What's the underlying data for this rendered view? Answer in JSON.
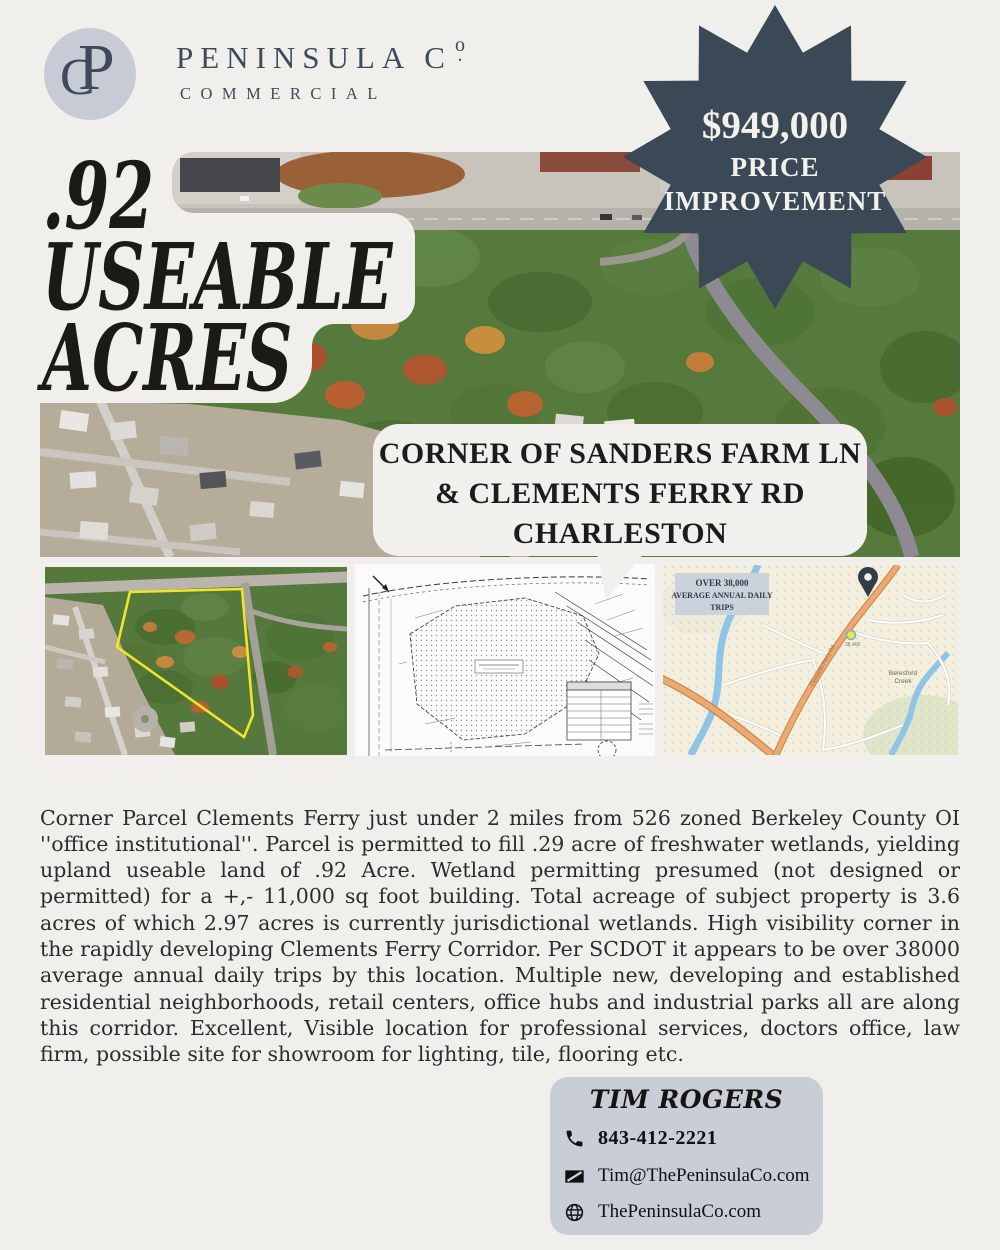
{
  "colors": {
    "cream": "#f1efeb",
    "navy": "#3b4957",
    "brand_navy": "#3e4a5c",
    "logo_circle": "#c6cbd6",
    "card_bg": "#c9cdd5",
    "headline_black": "#1a1a17",
    "parcel_outline_yellow": "#f2e428",
    "map_road_orange": "#eda96f"
  },
  "brand": {
    "monogram_c": "C",
    "monogram_p": "P",
    "name": "PENINSULA C",
    "name_o": "o",
    "name_dot": ".",
    "tagline": "COMMERCIAL"
  },
  "price_badge": {
    "amount": "$949,000",
    "line2": "PRICE",
    "line3": "IMPROVEMENT"
  },
  "headline": {
    "line1": ".92",
    "line2": "USEABLE",
    "line3": "ACRES"
  },
  "location_callout": {
    "line1": "CORNER OF SANDERS FARM LN",
    "line2": "& CLEMENTS FERRY RD",
    "line3": "CHARLESTON"
  },
  "map": {
    "aadt_line1": "OVER 38,000",
    "aadt_line2": "AVERAGE ANNUAL DAILY",
    "aadt_line3": "TRIPS",
    "creek_line1": "Beresford",
    "creek_line2": "Creek",
    "road_label": "Clements Ferry Rd",
    "traffic_count": "38,400"
  },
  "description": "Corner Parcel Clements Ferry just under 2 miles from 526 zoned Berkeley County OI ''office institutional''. Parcel is permitted to fill .29 acre of freshwater wetlands, yielding upland useable land of .92 Acre. Wetland permitting presumed (not designed or permitted) for a +,- 11,000 sq foot building. Total acreage of subject property is 3.6 acres of which 2.97 acres is currently jurisdictional wetlands. High visibility corner in the rapidly developing Clements Ferry Corridor. Per SCDOT it appears to be over 38000 average annual daily trips by this location. Multiple new, developing and established residential neighborhoods, retail centers, office hubs and industrial parks all are along this corridor. Excellent, Visible location for professional services, doctors office, law firm, possible site for showroom for lighting, tile, flooring etc.",
  "contact": {
    "name": "TIM ROGERS",
    "phone": "843-412-2221",
    "email": "Tim@ThePeninsulaCo.com",
    "website": "ThePeninsulaCo.com"
  }
}
